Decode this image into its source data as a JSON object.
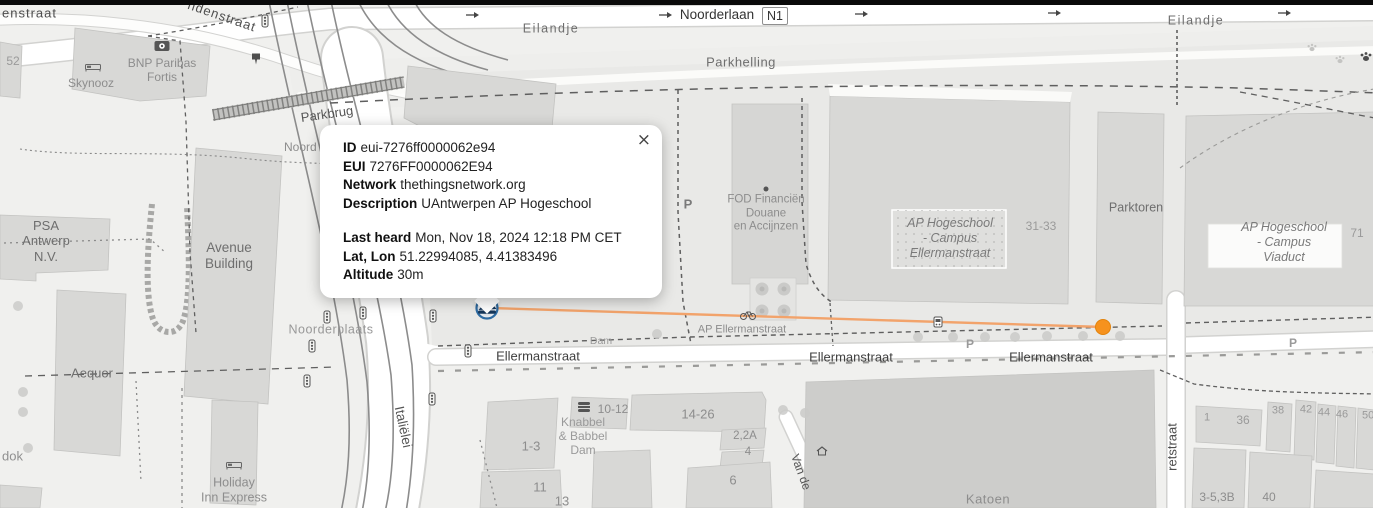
{
  "popup": {
    "close_label": "×",
    "rows": [
      {
        "label": "ID",
        "value": "eui-7276ff0000062e94"
      },
      {
        "label": "EUI",
        "value": "7276FF0000062E94"
      },
      {
        "label": "Network",
        "value": "thethingsnetwork.org"
      },
      {
        "label": "Description",
        "value": "UAntwerpen AP Hogeschool"
      },
      {
        "label": "Last heard",
        "value": "Mon, Nov 18, 2024 12:18 PM CET"
      },
      {
        "label": "Lat, Lon",
        "value": "51.22994085, 4.41383496"
      },
      {
        "label": "Altitude",
        "value": "30m"
      }
    ]
  },
  "colors": {
    "coverage_line": "#f2a36b",
    "device_marker": "#f6921e",
    "gateway_ring": "#2f6ca3",
    "gateway_glyph": "#16395f"
  },
  "map": {
    "route_badge": "N1",
    "labels": [
      {
        "name": "street-label-enstraat",
        "text": "enstraat",
        "x": 2,
        "y": 13,
        "size": 13,
        "color": "#4d4d4d",
        "ls": 1,
        "align": "left"
      },
      {
        "name": "housenumber-52",
        "text": "52",
        "x": 13,
        "y": 61,
        "size": 12,
        "color": "#9a9a9a"
      },
      {
        "name": "poi-label-skynooz",
        "text": "Skynooz",
        "x": 91,
        "y": 83,
        "size": 12,
        "color": "#8d8d8d"
      },
      {
        "name": "poi-label-bnp-paribas-fortis",
        "text": "BNP Paribas\nFortis",
        "x": 162,
        "y": 70,
        "size": 12,
        "color": "#8d8d8d"
      },
      {
        "name": "street-label-ndenstraat",
        "text": "ndenstraat",
        "x": 222,
        "y": 16,
        "size": 13,
        "color": "#4d4d4d",
        "rot": 19,
        "ls": 1
      },
      {
        "name": "street-label-noorderlaan",
        "text": "Noorderlaan",
        "x": 717,
        "y": 15,
        "size": 13.5,
        "color": "#333333"
      },
      {
        "name": "street-label-eilandje-west",
        "text": "Eilandje",
        "x": 551,
        "y": 29,
        "size": 12.5,
        "color": "#6e6e6e",
        "ls": 1.5
      },
      {
        "name": "street-label-eilandje-east",
        "text": "Eilandje",
        "x": 1196,
        "y": 21,
        "size": 12.5,
        "color": "#6e6e6e",
        "ls": 1.5
      },
      {
        "name": "area-label-parkhelling",
        "text": "Parkhelling",
        "x": 741,
        "y": 62,
        "size": 13,
        "color": "#6e6e6e",
        "ls": 0.5
      },
      {
        "name": "poi-label-parkbrug",
        "text": "Parkbrug",
        "x": 327,
        "y": 114,
        "size": 13,
        "color": "#555555",
        "rot": -8
      },
      {
        "name": "street-label-noord-partial",
        "text": "Noord",
        "x": 284,
        "y": 147,
        "size": 12,
        "color": "#8d8d8d",
        "align": "left"
      },
      {
        "name": "poi-label-psa-antwerp",
        "text": "PSA\nAntwerp\nN.V.",
        "x": 46,
        "y": 241,
        "size": 13,
        "color": "#6e6e6e"
      },
      {
        "name": "poi-label-avenue-building",
        "text": "Avenue\nBuilding",
        "x": 229,
        "y": 256,
        "size": 13.5,
        "color": "#6e6e6e"
      },
      {
        "name": "poi-label-aequor",
        "text": "Aequor",
        "x": 92,
        "y": 373,
        "size": 13,
        "color": "#6e6e6e"
      },
      {
        "name": "street-label-dok-partial",
        "text": "dok",
        "x": 2,
        "y": 456,
        "size": 13,
        "color": "#909090",
        "align": "left"
      },
      {
        "name": "poi-label-holiday-inn-express",
        "text": "Holiday\nInn Express",
        "x": 234,
        "y": 490,
        "size": 12.5,
        "color": "#8d8d8d"
      },
      {
        "name": "square-label-noorderplaats",
        "text": "Noorderplaats",
        "x": 331,
        "y": 330,
        "size": 12.5,
        "color": "#989898",
        "ls": 0.5
      },
      {
        "name": "street-label-italielei",
        "text": "Italiëlei",
        "x": 403,
        "y": 427,
        "size": 13.5,
        "color": "#555555",
        "rot": 78
      },
      {
        "name": "street-label-ellermanstraat-1",
        "text": "Ellermanstraat",
        "x": 538,
        "y": 356,
        "size": 13,
        "color": "#3f3f3f"
      },
      {
        "name": "street-label-ellermanstraat-2",
        "text": "Ellermanstraat",
        "x": 851,
        "y": 357,
        "size": 13,
        "color": "#3f3f3f"
      },
      {
        "name": "street-label-ellermanstraat-3",
        "text": "Ellermanstraat",
        "x": 1051,
        "y": 357,
        "size": 13,
        "color": "#3f3f3f"
      },
      {
        "name": "stop-label-ap-ellermanstraat",
        "text": "AP Ellermanstraat",
        "x": 742,
        "y": 330,
        "size": 11,
        "color": "#8d8d8d"
      },
      {
        "name": "street-label-dam-partial",
        "text": "Dam",
        "x": 601,
        "y": 341,
        "size": 10.5,
        "color": "#9a9a9a"
      },
      {
        "name": "poi-label-fod-financien",
        "text": "FOD Financiën\nDouane\nen Accijnzen",
        "x": 766,
        "y": 214,
        "size": 11.5,
        "color": "#8d8d8d"
      },
      {
        "name": "poi-label-ap-campus-ellermanstraat",
        "text": "AP Hogeschool\n- Campus\nEllermanstraat",
        "x": 950,
        "y": 238,
        "size": 12.5,
        "color": "#7a7a7a",
        "italic": true
      },
      {
        "name": "housenumber-31-33",
        "text": "31-33",
        "x": 1041,
        "y": 226,
        "size": 12,
        "color": "#9a9a9a"
      },
      {
        "name": "poi-label-parktoren",
        "text": "Parktoren",
        "x": 1136,
        "y": 208,
        "size": 12.5,
        "color": "#6e6e6e"
      },
      {
        "name": "poi-label-ap-campus-viaduct",
        "text": "AP Hogeschool\n- Campus\nViaduct",
        "x": 1284,
        "y": 242,
        "size": 12.5,
        "color": "#7a7a7a",
        "italic": true
      },
      {
        "name": "housenumber-71",
        "text": "71",
        "x": 1357,
        "y": 233,
        "size": 12,
        "color": "#9a9a9a"
      },
      {
        "name": "poi-label-katoen",
        "text": "Katoen",
        "x": 988,
        "y": 499,
        "size": 13,
        "color": "#8d8d8d",
        "ls": 0.5
      },
      {
        "name": "street-label-van-de",
        "text": "Van de",
        "x": 801,
        "y": 472,
        "size": 12,
        "color": "#555555",
        "rot": 70
      },
      {
        "name": "street-label-retstraat",
        "text": "retstraat",
        "x": 1172,
        "y": 447,
        "size": 13,
        "color": "#4d4d4d",
        "rot": -90
      },
      {
        "name": "housenumber-10-12",
        "text": "10-12",
        "x": 613,
        "y": 409,
        "size": 12,
        "color": "#8d8d8d"
      },
      {
        "name": "poi-label-knabbel-babbel",
        "text": "Knabbel\n& Babbel\nDam",
        "x": 583,
        "y": 436,
        "size": 12,
        "color": "#9a9a9a"
      },
      {
        "name": "housenumber-1-3",
        "text": "1-3",
        "x": 531,
        "y": 446,
        "size": 13,
        "color": "#8d8d8d"
      },
      {
        "name": "housenumber-14-26",
        "text": "14-26",
        "x": 698,
        "y": 414,
        "size": 13,
        "color": "#8d8d8d"
      },
      {
        "name": "housenumber-2-2a",
        "text": "2,2A",
        "x": 745,
        "y": 437,
        "size": 11.5,
        "color": "#8d8d8d"
      },
      {
        "name": "housenumber-4",
        "text": "4",
        "x": 748,
        "y": 453,
        "size": 11.5,
        "color": "#8d8d8d"
      },
      {
        "name": "housenumber-6",
        "text": "6",
        "x": 733,
        "y": 480,
        "size": 13,
        "color": "#8d8d8d"
      },
      {
        "name": "housenumber-11",
        "text": "11",
        "x": 540,
        "y": 487,
        "size": 13,
        "color": "#8d8d8d"
      },
      {
        "name": "housenumber-13",
        "text": "13",
        "x": 562,
        "y": 501,
        "size": 13,
        "color": "#8d8d8d"
      },
      {
        "name": "housenumber-1",
        "text": "1",
        "x": 1207,
        "y": 418,
        "size": 11,
        "color": "#9a9a9a"
      },
      {
        "name": "housenumber-36",
        "text": "36",
        "x": 1243,
        "y": 420,
        "size": 12,
        "color": "#9a9a9a"
      },
      {
        "name": "housenumber-38",
        "text": "38",
        "x": 1278,
        "y": 411,
        "size": 11,
        "color": "#9a9a9a"
      },
      {
        "name": "housenumber-42",
        "text": "42",
        "x": 1306,
        "y": 410,
        "size": 11,
        "color": "#9a9a9a"
      },
      {
        "name": "housenumber-44",
        "text": "44",
        "x": 1324,
        "y": 413,
        "size": 11,
        "color": "#9a9a9a"
      },
      {
        "name": "housenumber-46",
        "text": "46",
        "x": 1342,
        "y": 415,
        "size": 11,
        "color": "#9a9a9a"
      },
      {
        "name": "housenumber-50-partial",
        "text": "50",
        "x": 1362,
        "y": 416,
        "size": 11,
        "color": "#9a9a9a",
        "align": "left"
      },
      {
        "name": "housenumber-3-5-3b",
        "text": "3-5,3B",
        "x": 1217,
        "y": 497,
        "size": 12,
        "color": "#8d8d8d"
      },
      {
        "name": "housenumber-40",
        "text": "40",
        "x": 1269,
        "y": 497,
        "size": 12,
        "color": "#8d8d8d"
      },
      {
        "name": "parking-label-1",
        "text": "P",
        "x": 688,
        "y": 204,
        "size": 13,
        "color": "#7a7a7a",
        "bold": true
      },
      {
        "name": "parking-label-2",
        "text": "P",
        "x": 970,
        "y": 344,
        "size": 12,
        "color": "#9a9a9a",
        "bold": true
      },
      {
        "name": "parking-label-3",
        "text": "P",
        "x": 1293,
        "y": 343,
        "size": 12,
        "color": "#9a9a9a",
        "bold": true
      }
    ],
    "icons": [
      {
        "type": "bed",
        "x": 93,
        "y": 67
      },
      {
        "type": "bed",
        "x": 234,
        "y": 465
      },
      {
        "type": "bank",
        "x": 162,
        "y": 46
      },
      {
        "type": "atm",
        "x": 256,
        "y": 59
      },
      {
        "type": "burger",
        "x": 584,
        "y": 407
      },
      {
        "type": "traffic",
        "x": 265,
        "y": 21
      },
      {
        "type": "traffic",
        "x": 327,
        "y": 317
      },
      {
        "type": "traffic",
        "x": 312,
        "y": 346
      },
      {
        "type": "traffic",
        "x": 307,
        "y": 381
      },
      {
        "type": "traffic",
        "x": 363,
        "y": 313
      },
      {
        "type": "traffic",
        "x": 433,
        "y": 316
      },
      {
        "type": "traffic",
        "x": 468,
        "y": 351
      },
      {
        "type": "traffic",
        "x": 432,
        "y": 399
      },
      {
        "type": "bus",
        "x": 938,
        "y": 322
      },
      {
        "type": "bike",
        "x": 748,
        "y": 315
      },
      {
        "type": "house",
        "x": 822,
        "y": 451
      },
      {
        "type": "dot",
        "x": 766,
        "y": 189
      },
      {
        "type": "paw",
        "x": 1366,
        "y": 56
      },
      {
        "type": "paw-light",
        "x": 1312,
        "y": 47
      },
      {
        "type": "paw-light",
        "x": 1340,
        "y": 59
      },
      {
        "type": "arrow",
        "x": 473,
        "y": 15
      },
      {
        "type": "arrow",
        "x": 666,
        "y": 15
      },
      {
        "type": "arrow",
        "x": 862,
        "y": 14
      },
      {
        "type": "arrow",
        "x": 1055,
        "y": 13
      },
      {
        "type": "arrow",
        "x": 1285,
        "y": 13
      }
    ]
  }
}
